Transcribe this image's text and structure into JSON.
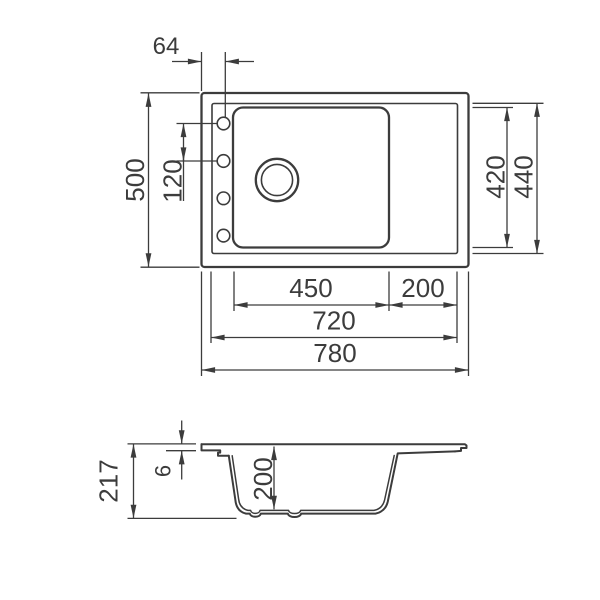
{
  "drawing": {
    "title": "sink-dimension-drawing",
    "line_color": "#3c3c3c",
    "background_color": "#ffffff",
    "top_view": {
      "overall_width": "780",
      "inner_width": "720",
      "bowl_width": "450",
      "drainboard_width": "200",
      "overall_depth": "500",
      "inner_depth": "440",
      "bowl_depth": "420",
      "faucet_hole_offset": "64",
      "faucet_hole_spacing": "120",
      "faucet_hole_count": 4
    },
    "section_view": {
      "overall_height": "217",
      "rim_thickness": "6",
      "bowl_depth": "200"
    }
  }
}
